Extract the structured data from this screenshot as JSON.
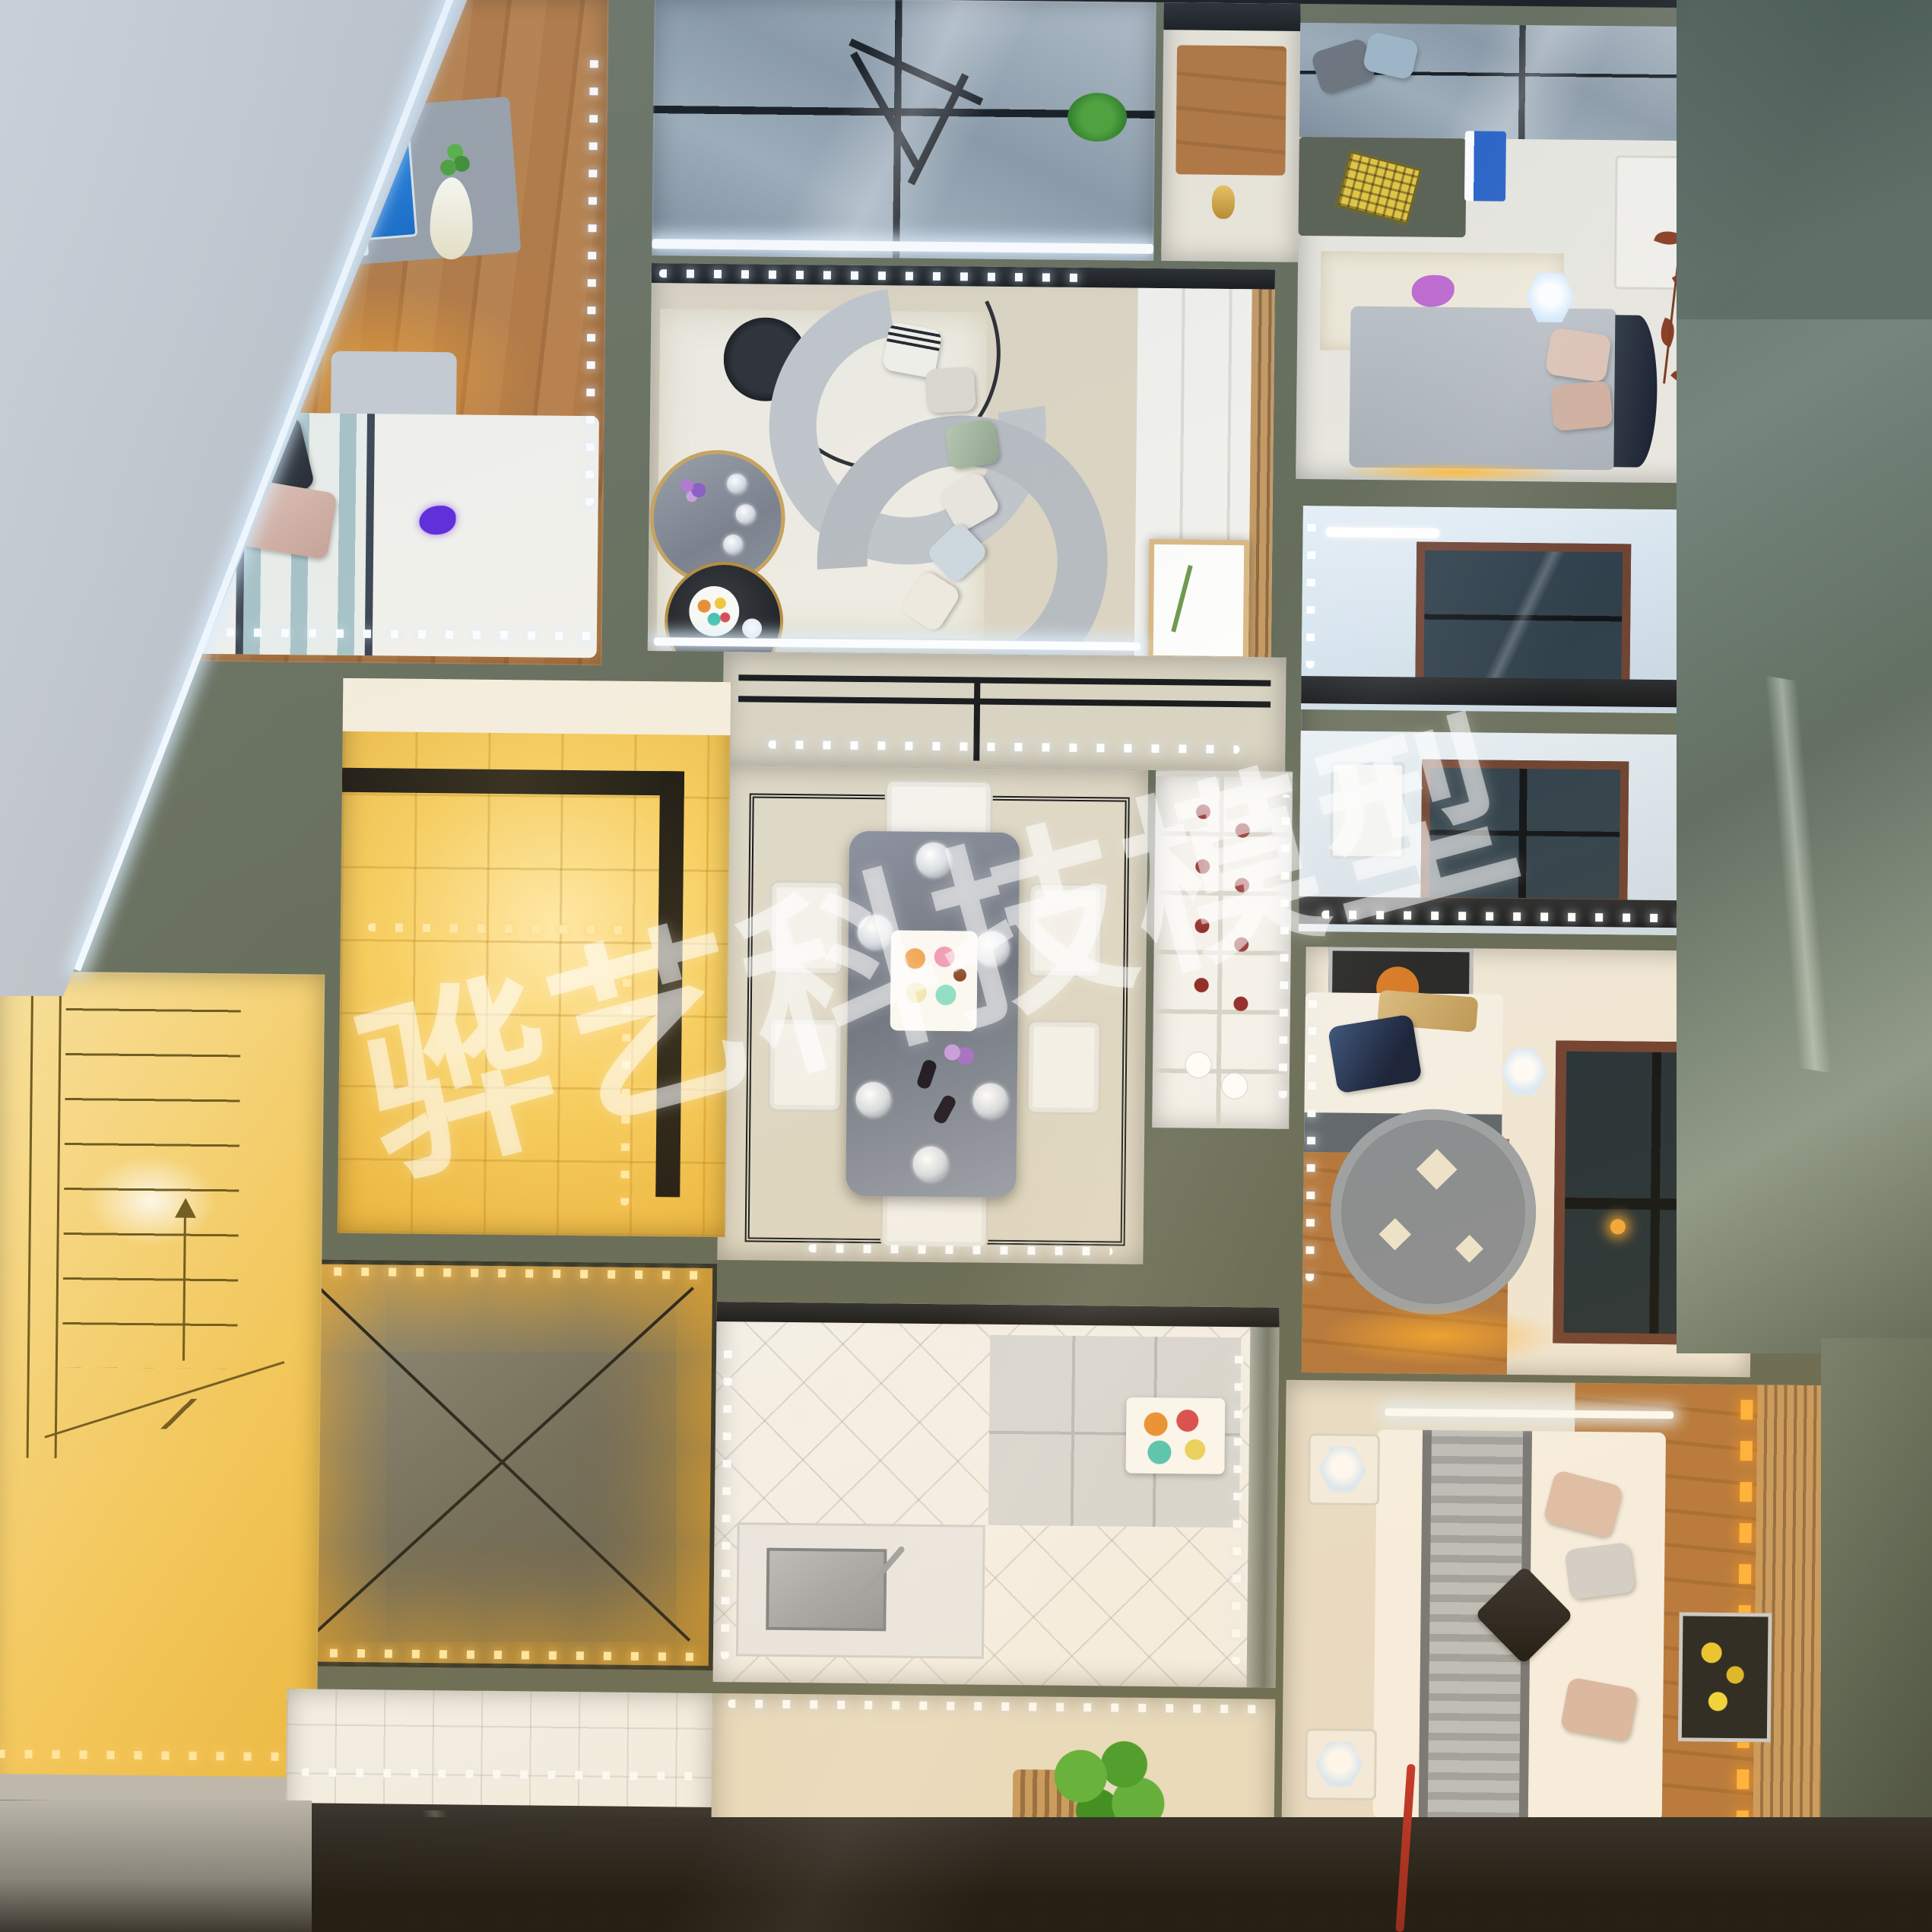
{
  "watermark": {
    "text": "骅艺科技模型"
  },
  "monitor": {
    "label": "Windows 7"
  },
  "palette": {
    "wall_sage": "#6b7260",
    "warm_led": "#f6b73c",
    "warm_tile": "#f2cf62",
    "cool_led": "#e8f3ff",
    "wood": "#b0763e",
    "sofa_gray": "#c0c4c8",
    "glass_blue": "#90a0ad",
    "marble_right_bg": "#66766d",
    "marble_topleft_bg": "#c9cdd1",
    "dining_marble": "#7c828c",
    "accent_wire_red": "#c4302b",
    "dark_base": "#16181b"
  }
}
